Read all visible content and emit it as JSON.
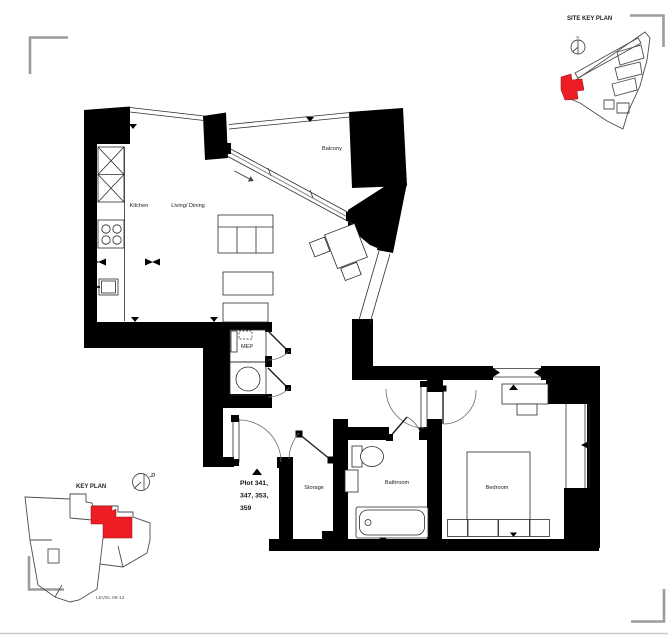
{
  "rooms": {
    "kitchen": "Kitchen",
    "living_dining": "Living/ Dining",
    "balcony": "Balcony",
    "mep": "MEP",
    "storage": "Storage",
    "bathroom": "Bathroom",
    "bedroom": "Bedroom"
  },
  "plot_label": {
    "line1": "Plot 341,",
    "line2": "347, 353,",
    "line3": "359"
  },
  "site_key_plan": {
    "title": "SITE KEY PLAN",
    "north_label": "N"
  },
  "key_plan": {
    "title": "KEY PLAN",
    "level_label": "LEVEL 09-12"
  },
  "colors": {
    "highlight": "#ee1c24",
    "wall": "#000000",
    "corner_mark": "#9c9c9c",
    "outline": "#4d4d4d",
    "label": "#1a1a1a"
  }
}
